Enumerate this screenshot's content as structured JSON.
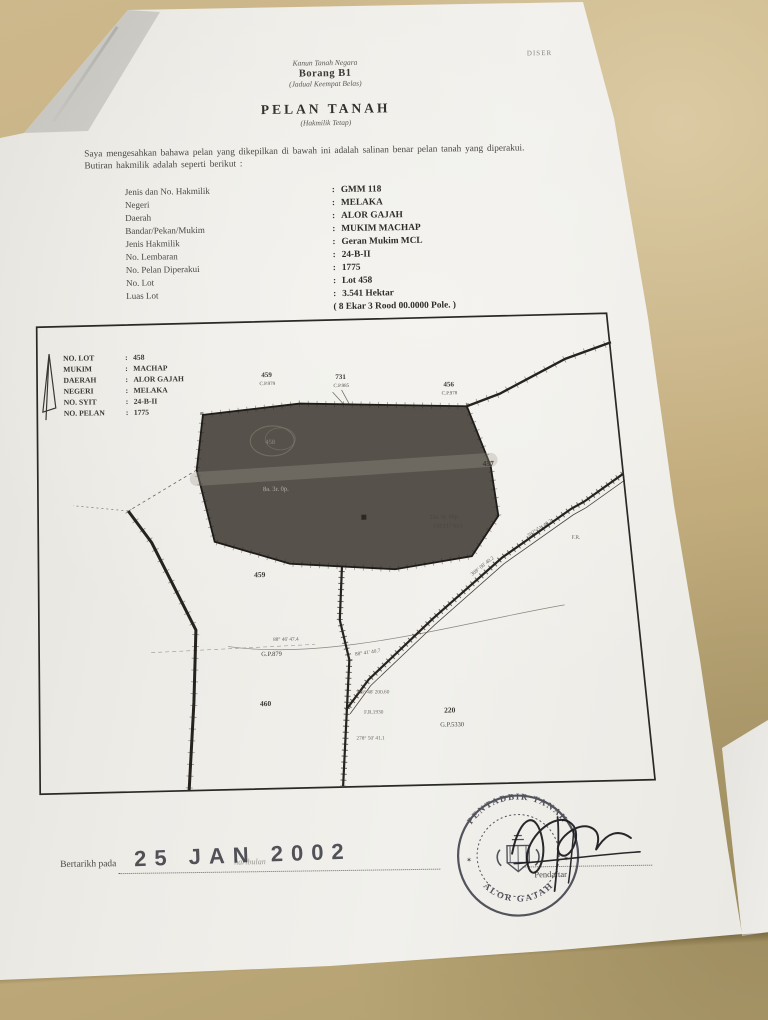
{
  "header": {
    "corner_note": "DISER",
    "law": "Kanun Tanah Negara",
    "form_no": "Borang B1",
    "schedule": "(Jadual Keempat Belas)",
    "title": "PELAN TANAH",
    "subtitle": "(Hakmilik Tetap)"
  },
  "certification": {
    "line1": "Saya mengesahkan bahawa pelan yang dikepilkan di bawah ini adalah salinan benar pelan tanah yang diperakui.",
    "line2": "Butiran hakmilik adalah seperti berikut :"
  },
  "details": {
    "separator": ":",
    "rows": [
      {
        "label": "Jenis dan No. Hakmilik",
        "value": "GMM 118"
      },
      {
        "label": "Negeri",
        "value": "MELAKA"
      },
      {
        "label": "Daerah",
        "value": "ALOR GAJAH"
      },
      {
        "label": "Bandar/Pekan/Mukim",
        "value": "MUKIM MACHAP"
      },
      {
        "label": "Jenis Hakmilik",
        "value": "Geran Mukim MCL"
      },
      {
        "label": "No. Lembaran",
        "value": "24-B-II"
      },
      {
        "label": "No. Pelan Diperakui",
        "value": "1775"
      },
      {
        "label": "No. Lot",
        "value": "Lot 458"
      },
      {
        "label": "Luas Lot",
        "value": "3.541 Hektar"
      },
      {
        "label": "",
        "value": "( 8 Ekar 3 Rood 00.0000 Pole. )"
      }
    ]
  },
  "plan": {
    "info": {
      "separator": ":",
      "rows": [
        {
          "label": "NO. LOT",
          "value": "458"
        },
        {
          "label": "MUKIM",
          "value": "MACHAP"
        },
        {
          "label": "DAERAH",
          "value": "ALOR GAJAH"
        },
        {
          "label": "NEGERI",
          "value": "MELAKA"
        },
        {
          "label": "NO. SYIT",
          "value": "24-B-II"
        },
        {
          "label": "NO. PELAN",
          "value": "1775"
        }
      ]
    },
    "map": {
      "labels": {
        "lot459_top": "459",
        "cp459": "C.P.979",
        "lot731": "731",
        "cp731": "C.P.985",
        "lot456": "456",
        "cp456": "C.P.978",
        "lot457": "457",
        "lot459": "459",
        "gp879": "G.P.879",
        "lot460": "460",
        "lot220": "220",
        "gp5330": "G.P.5330",
        "area25": "25a. 0r. 00p.",
        "area25ha": "(10.117 ha.)",
        "lot_area": "8a. 3r. 0p.",
        "lot_circled": "458"
      },
      "bearings": {
        "b1": "302° 51' 40.2",
        "b2": "308° 08' 40.2",
        "b3": "88° 41' 40.7",
        "b4": "88° 46' 47.4",
        "b5": "358° 48' 200.60",
        "b6": "F.R.1930",
        "b7": "278° 50' 41.1",
        "b8": "F.R."
      }
    }
  },
  "footer": {
    "dated_label": "Bertarikh pada",
    "haribulan": "haribulan",
    "date_stamp": "25 JAN 2002",
    "signature_title": "Pendaftar",
    "stamp_top": "PENTADBIR TANAH",
    "stamp_bottom": "ALOR GAJAH",
    "star": "✶"
  }
}
